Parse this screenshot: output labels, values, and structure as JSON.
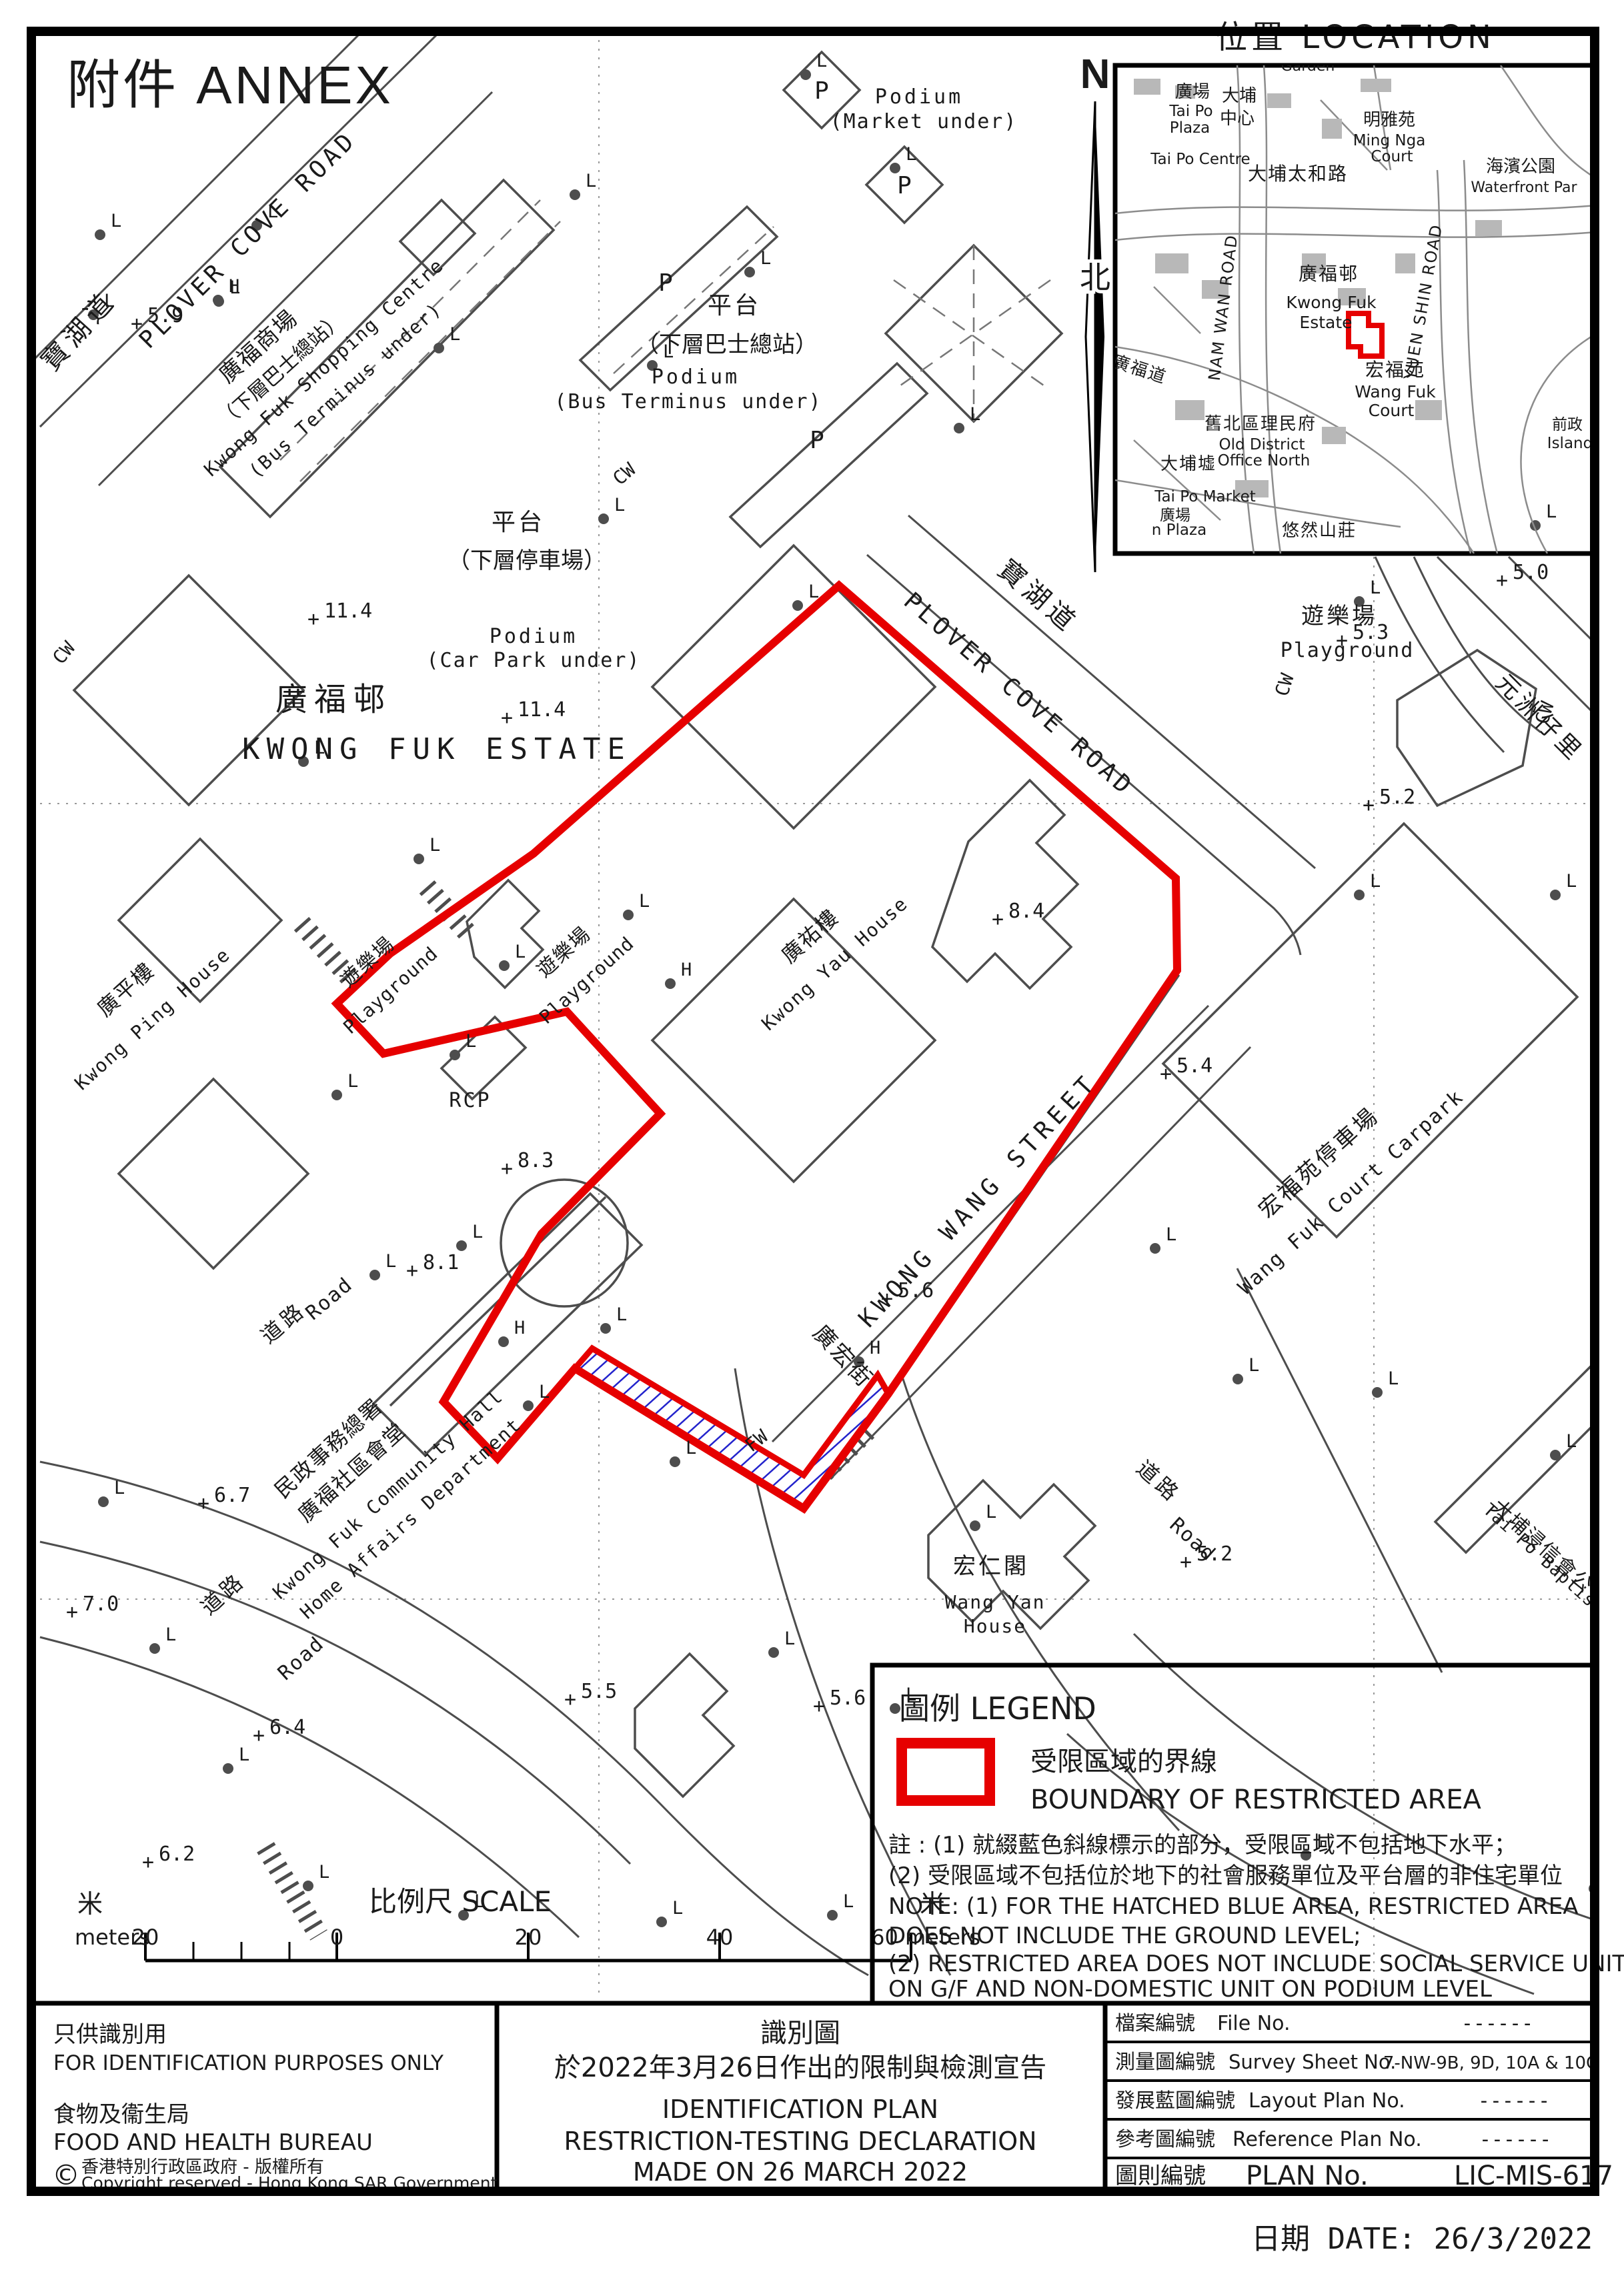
{
  "page": {
    "annex": "附件 ANNEX",
    "date_label": "日期 DATE:  26/3/2022"
  },
  "location": {
    "title": "位置   LOCATION"
  },
  "north": {
    "n": "N",
    "zh": "北"
  },
  "legend": {
    "title": "圖例 LEGEND",
    "boundary_zh": "受限區域的界線",
    "boundary_en": "BOUNDARY OF RESTRICTED AREA",
    "note1": "註 : (1) 就綴藍色斜線標示的部分，受限區域不包括地下水平；",
    "note2": "(2) 受限區域不包括位於地下的社會服務單位及平台層的非住宅單位",
    "note3": "NOTE: (1) FOR THE HATCHED BLUE AREA, RESTRICTED AREA",
    "note4": "DOES NOT INCLUDE THE GROUND LEVEL;",
    "note5": "(2) RESTRICTED AREA DOES NOT INCLUDE SOCIAL SERVICE UNIT",
    "note6": "ON G/F AND NON-DOMESTIC UNIT ON PODIUM LEVEL"
  },
  "scale": {
    "unit_left": "米",
    "meters_left": "meters",
    "n20a": "20",
    "n0": "0",
    "n20b": "20",
    "n40": "40",
    "n60": "60 meters",
    "unit_right": "米",
    "title": "比例尺  SCALE"
  },
  "titleblock": {
    "left": {
      "l1": "只供識別用",
      "l2": "FOR IDENTIFICATION PURPOSES ONLY",
      "l3": "食物及衞生局",
      "l4": "FOOD AND HEALTH BUREAU",
      "copy_symbol": "©",
      "l5": "香港特別行政區政府 - 版權所有",
      "l6": "Copyright reserved - Hong Kong SAR Government"
    },
    "middle": {
      "m1": "識別圖",
      "m2": "於2022年3月26日作出的限制與檢測宣告",
      "m3": "IDENTIFICATION PLAN",
      "m4": "RESTRICTION-TESTING DECLARATION",
      "m5": "MADE ON 26 MARCH 2022"
    },
    "rows": {
      "r1zh": "檔案編號",
      "r1en": "File  No.",
      "r1val": "------",
      "r2zh": "測量圖編號",
      "r2en": "Survey  Sheet  No.",
      "r2val": "7-NW-9B, 9D, 10A & 10C",
      "r3zh": "發展藍圖編號",
      "r3en": "Layout  Plan  No.",
      "r3val": "------",
      "r4zh": "參考圖編號",
      "r4en": "Reference  Plan  No.",
      "r4val": "------",
      "r5zh": "圖則編號",
      "r5en": "PLAN  No.",
      "r5val": "LIC-MIS-617"
    }
  },
  "map": {
    "glyphs": {
      "l": "L",
      "h": "H",
      "p": "P",
      "plus": "+"
    },
    "labels": [
      [
        "PLOVER COVE ROAD",
        380,
        368,
        36,
        -45,
        1,
        6
      ],
      [
        "寶湖道",
        128,
        505,
        40,
        -48,
        0,
        8
      ],
      [
        "廣福商場",
        395,
        528,
        34,
        -42,
        0,
        2
      ],
      [
        "（下層巴士總站）",
        428,
        562,
        30,
        -42,
        0,
        0
      ],
      [
        "Kwong Fuk Shopping Centre",
        492,
        558,
        28,
        -42,
        1,
        2
      ],
      [
        "(Bus Terminus under)",
        524,
        592,
        28,
        -42,
        1,
        2
      ],
      [
        "Podium",
        1378,
        155,
        30,
        0,
        1,
        4
      ],
      [
        "(Market under)",
        1385,
        192,
        30,
        0,
        1,
        2
      ],
      [
        "平台",
        1101,
        470,
        36,
        0,
        0,
        4
      ],
      [
        "（下層巴士總站）",
        1090,
        528,
        34,
        0,
        0,
        0
      ],
      [
        "Podium",
        1043,
        575,
        30,
        0,
        1,
        4
      ],
      [
        "(Bus Terminus under)",
        1032,
        612,
        30,
        0,
        1,
        2
      ],
      [
        "平台",
        777,
        795,
        36,
        0,
        0,
        4
      ],
      [
        "（下層停車場）",
        790,
        852,
        34,
        0,
        0,
        0
      ],
      [
        "Podium",
        800,
        964,
        30,
        0,
        1,
        4
      ],
      [
        "(Car Park under)",
        800,
        1000,
        30,
        0,
        1,
        2
      ],
      [
        "廣福邨",
        500,
        1065,
        48,
        0,
        0,
        10
      ],
      [
        "KWONG FUK ESTATE",
        655,
        1138,
        44,
        0,
        1,
        10
      ],
      [
        "寶湖道",
        1548,
        905,
        40,
        41,
        0,
        8
      ],
      [
        "PLOVER COVE ROAD",
        1520,
        1050,
        36,
        41,
        1,
        6
      ],
      [
        "遊樂場",
        2008,
        935,
        34,
        0,
        0,
        4
      ],
      [
        "Playground",
        2020,
        985,
        30,
        0,
        1,
        2
      ],
      [
        "CW",
        942,
        718,
        28,
        -40,
        1,
        0
      ],
      [
        "CW",
        1935,
        1030,
        28,
        -72,
        1,
        0
      ],
      [
        "CW",
        2325,
        1072,
        28,
        -72,
        1,
        0
      ],
      [
        "CW",
        103,
        985,
        28,
        -50,
        1,
        0
      ],
      [
        "元洲仔里",
        2300,
        1085,
        36,
        45,
        0,
        6
      ],
      [
        "廣平樓",
        196,
        1492,
        32,
        -42,
        0,
        2
      ],
      [
        "Kwong Ping House",
        235,
        1535,
        28,
        -42,
        1,
        2
      ],
      [
        "遊樂場",
        558,
        1450,
        30,
        -42,
        0,
        2
      ],
      [
        "Playground",
        592,
        1492,
        28,
        -42,
        1,
        1
      ],
      [
        "遊樂場",
        852,
        1435,
        30,
        -42,
        0,
        2
      ],
      [
        "Playground",
        886,
        1477,
        28,
        -42,
        1,
        1
      ],
      [
        "廣祐樓",
        1222,
        1412,
        32,
        -42,
        0,
        2
      ],
      [
        "Kwong Yau House",
        1258,
        1452,
        28,
        -42,
        1,
        2
      ],
      [
        "RCP",
        705,
        1660,
        30,
        0,
        1,
        3
      ],
      [
        "KWONG WANG STREET",
        1475,
        1808,
        36,
        -47,
        1,
        8
      ],
      [
        "宏福苑停車場",
        1985,
        1752,
        34,
        -42,
        0,
        4
      ],
      [
        "Wang Fuk Court Carpark",
        2032,
        1795,
        30,
        -42,
        1,
        2
      ],
      [
        "廣宏街",
        1256,
        2042,
        34,
        47,
        0,
        4
      ],
      [
        "FW",
        1140,
        2168,
        28,
        -38,
        1,
        0
      ],
      [
        "民政事務總署",
        500,
        2180,
        32,
        -42,
        0,
        2
      ],
      [
        "廣福社區會堂",
        535,
        2216,
        32,
        -42,
        0,
        2
      ],
      [
        "Kwong Fuk Community Hall",
        588,
        2248,
        28,
        -42,
        1,
        2
      ],
      [
        "Home Affairs Department",
        622,
        2284,
        28,
        -42,
        1,
        2
      ],
      [
        "宏仁閣",
        1486,
        2360,
        34,
        0,
        0,
        4
      ],
      [
        "Wang Yan",
        1492,
        2412,
        28,
        0,
        1,
        2
      ],
      [
        "House",
        1492,
        2448,
        28,
        0,
        1,
        2
      ],
      [
        "道路",
        432,
        1992,
        32,
        -40,
        0,
        6
      ],
      [
        "Road",
        500,
        1955,
        30,
        -40,
        1,
        2
      ],
      [
        "道路",
        342,
        2398,
        32,
        -42,
        0,
        6
      ],
      [
        "Road",
        458,
        2494,
        30,
        -42,
        1,
        2
      ],
      [
        "道路",
        1730,
        2230,
        32,
        42,
        0,
        6
      ],
      [
        "Road",
        1782,
        2316,
        30,
        42,
        1,
        2
      ],
      [
        "大埔浸信會公",
        2306,
        2326,
        30,
        42,
        0,
        2
      ],
      [
        "Tai Po Baptist Publ",
        2340,
        2372,
        26,
        42,
        1,
        1
      ]
    ],
    "spots": [
      [
        "5.9",
        205,
        495
      ],
      [
        "11.4",
        470,
        938
      ],
      [
        "11.4",
        760,
        1086
      ],
      [
        "8.4",
        1496,
        1388
      ],
      [
        "5.0",
        2252,
        880
      ],
      [
        "5.3",
        2012,
        970
      ],
      [
        "5.2",
        2052,
        1217
      ],
      [
        "5.4",
        1748,
        1620
      ],
      [
        "8.3",
        760,
        1762
      ],
      [
        "8.1",
        618,
        1915
      ],
      [
        "5.6",
        1330,
        1957
      ],
      [
        "6.7",
        305,
        2264
      ],
      [
        "7.0",
        108,
        2427
      ],
      [
        "6.4",
        388,
        2612
      ],
      [
        "6.2",
        222,
        2802
      ],
      [
        "5.5",
        855,
        2558
      ],
      [
        "5.6",
        1228,
        2568
      ],
      [
        "5.2",
        1778,
        2352
      ]
    ],
    "l_markers": [
      [
        150,
        352
      ],
      [
        140,
        472
      ],
      [
        385,
        338
      ],
      [
        328,
        452
      ],
      [
        658,
        522
      ],
      [
        862,
        292
      ],
      [
        978,
        548
      ],
      [
        1208,
        112
      ],
      [
        1342,
        252
      ],
      [
        1124,
        408
      ],
      [
        1438,
        642
      ],
      [
        905,
        778
      ],
      [
        1196,
        908
      ],
      [
        2038,
        902
      ],
      [
        2302,
        788
      ],
      [
        2392,
        1038
      ],
      [
        455,
        1142
      ],
      [
        628,
        1288
      ],
      [
        942,
        1372
      ],
      [
        756,
        1448
      ],
      [
        682,
        1582
      ],
      [
        505,
        1642
      ],
      [
        562,
        1912
      ],
      [
        692,
        1868
      ],
      [
        908,
        1992
      ],
      [
        792,
        2108
      ],
      [
        1012,
        2192
      ],
      [
        1462,
        2288
      ],
      [
        1160,
        2478
      ],
      [
        1342,
        2562
      ],
      [
        2065,
        2088
      ],
      [
        2332,
        2182
      ],
      [
        1958,
        2782
      ],
      [
        2390,
        2832
      ],
      [
        232,
        2472
      ],
      [
        342,
        2652
      ],
      [
        462,
        2828
      ],
      [
        695,
        2872
      ],
      [
        992,
        2882
      ],
      [
        1248,
        2872
      ],
      [
        155,
        2252
      ],
      [
        2038,
        1342
      ],
      [
        2332,
        1342
      ],
      [
        1732,
        1872
      ],
      [
        1856,
        2068
      ]
    ],
    "h_markers": [
      [
        327,
        450
      ],
      [
        1005,
        1475
      ],
      [
        1288,
        2042
      ],
      [
        755,
        2012
      ]
    ],
    "p_markers": [
      [
        1232,
        148
      ],
      [
        1356,
        290
      ],
      [
        998,
        436
      ],
      [
        1225,
        672
      ]
    ]
  },
  "inset": {
    "labels": [
      [
        "廣場",
        1788,
        146,
        26,
        0,
        0,
        0
      ],
      [
        "Tai Po",
        1786,
        174,
        23,
        0,
        0,
        0
      ],
      [
        "Plaza",
        1784,
        199,
        23,
        0,
        0,
        0
      ],
      [
        "大埔",
        1858,
        152,
        26,
        0,
        0,
        0
      ],
      [
        "中心",
        1855,
        186,
        26,
        0,
        0,
        0
      ],
      [
        "Garden",
        1961,
        106,
        22,
        0,
        0,
        0
      ],
      [
        "明雅苑",
        2083,
        188,
        26,
        0,
        0,
        0
      ],
      [
        "Ming Nga",
        2083,
        218,
        23,
        0,
        0,
        0
      ],
      [
        "Court",
        2087,
        242,
        23,
        0,
        0,
        0
      ],
      [
        "Tai Po Centre",
        1800,
        246,
        23,
        0,
        0,
        0
      ],
      [
        "大埔太和路",
        1946,
        270,
        28,
        0,
        0,
        2
      ],
      [
        "海濱公園",
        2280,
        258,
        26,
        0,
        0,
        0
      ],
      [
        "Waterfront Par",
        2285,
        288,
        22,
        0,
        0,
        0
      ],
      [
        "NAM WAN ROAD",
        1842,
        462,
        24,
        -83,
        0,
        2
      ],
      [
        "廣福邨",
        1992,
        420,
        28,
        0,
        0,
        2
      ],
      [
        "Kwong Fuk",
        1996,
        462,
        25,
        0,
        0,
        0
      ],
      [
        "Estate",
        1988,
        492,
        25,
        0,
        0,
        0
      ],
      [
        "YUEN SHIN ROAD",
        2142,
        454,
        24,
        -80,
        0,
        2
      ],
      [
        "宏福苑",
        2092,
        564,
        28,
        0,
        0,
        2
      ],
      [
        "Wang Fuk",
        2092,
        596,
        25,
        0,
        0,
        0
      ],
      [
        "Court",
        2086,
        624,
        25,
        0,
        0,
        0
      ],
      [
        "廣福道",
        1706,
        562,
        26,
        18,
        0,
        2
      ],
      [
        "舊北區理民府",
        1890,
        644,
        26,
        0,
        0,
        2
      ],
      [
        "Old District",
        1892,
        674,
        23,
        0,
        0,
        0
      ],
      [
        "Office North",
        1895,
        698,
        23,
        0,
        0,
        0
      ],
      [
        "大埔墟",
        1782,
        704,
        26,
        0,
        0,
        2
      ],
      [
        "Tai Po Market",
        1807,
        752,
        23,
        0,
        0,
        0
      ],
      [
        "廣場",
        1762,
        780,
        23,
        0,
        0,
        0
      ],
      [
        "n Plaza",
        1768,
        802,
        23,
        0,
        0,
        0
      ],
      [
        "悠然山莊",
        1978,
        804,
        26,
        0,
        0,
        2
      ],
      [
        "前政",
        2350,
        644,
        23,
        0,
        0,
        0
      ],
      [
        "Island",
        2354,
        672,
        23,
        0,
        0,
        0
      ]
    ]
  }
}
